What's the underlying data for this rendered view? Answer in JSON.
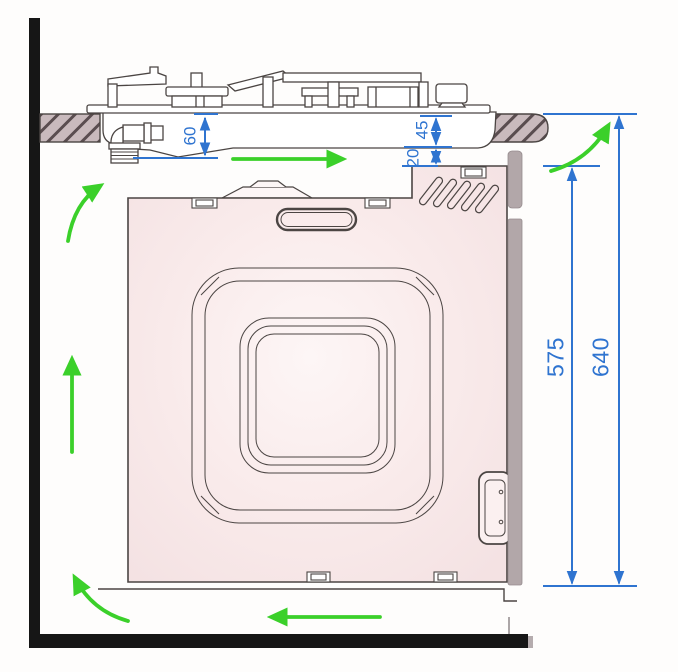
{
  "diagram": {
    "kind": "built-in-oven-installation-ventilation-diagram",
    "labels": {
      "dim_60": "60",
      "dim_45": "45",
      "dim_20": "20",
      "dim_575": "575",
      "dim_640": "640"
    },
    "colors": {
      "dimension_blue": "#2f74d0",
      "airflow_green": "#3bd02a",
      "oven_body_pink": "#f9eaea",
      "counter_hatch_fill": "#c9babd",
      "wall_black": "#161616",
      "door_edge_gray": "#b2a7a9",
      "outline": "#4b4543"
    },
    "airflow_arrows": [
      "under-hob-right",
      "up-behind-worktop-right",
      "up-left-side",
      "up-bottom-left",
      "along-plinth-left",
      "up-left-wall"
    ]
  }
}
